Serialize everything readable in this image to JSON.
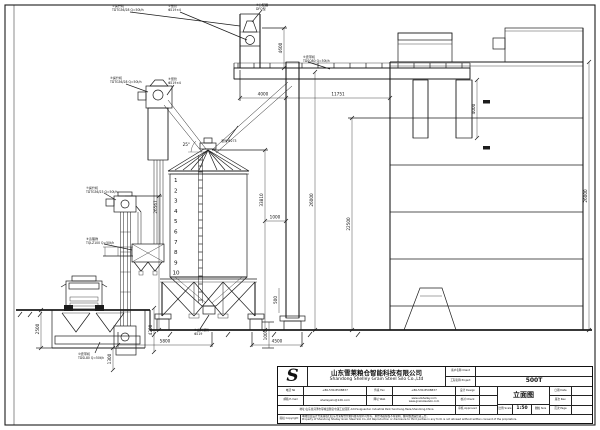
{
  "titleblock": {
    "logo": "S",
    "company_cn": "山东雪莱粮仓智能科技有限公司",
    "company_en": "Shandong Shelley Grain Steel Silo Co.,Ltd",
    "client_label": "客户名称 Client",
    "project_label": "工程名称 Project",
    "project_value": "500T",
    "tel_label": "电话 Tel",
    "tel_value": "+86-530-8508837",
    "fax_label": "传真 Fax",
    "fax_value": "+86-530-8508837",
    "email_label": "邮箱 E-mail",
    "email_value": "shelleysilo@126.com",
    "web_label": "网址 Web",
    "web_value1": "www.sdshelley.com",
    "web_value2": "www.grainsteelsilo.com",
    "address": "地址:山东省菏泽市郓城县随官屯镇工业园区  Add:Suiguantun Industrial Park,Yuncheng,Heze,Shandong,China",
    "design_label": "设计 Design",
    "check_label": "校对 Check",
    "approve_label": "审核 Approved",
    "date_label": "日期 Date",
    "rev_label": "版次 Rev.",
    "page_label": "页次 Page",
    "drawing_title": "立面图",
    "scale_label": "比例 Scale",
    "scale_value": "1:50",
    "size_label": "图幅 Size",
    "note_label": "版权 Copyright",
    "notice_cn": "本图纸及设计方案版权归山东雪莱粮仓智能科技有限公司所有，未经书面授权不得复制、翻印或透露给第三方。",
    "notice_en": "Property of Shandong Shelley Grain Steel Silo Co.,Ltd Reproduction or disclosure to third parties in any form is not allowed without written consent of the proprietors."
  },
  "dims": {
    "top_left": "4000",
    "top_span": "11751",
    "head_tower": "4600",
    "col_right": "4000",
    "tower_h": "26000",
    "building_h2": "22500",
    "silo_total": "33810",
    "silo_gap": "1000",
    "footing": "500",
    "elev_total": "26567",
    "building_right": "26000",
    "pit_depth": "2500",
    "pit_right": "4200",
    "pit_below": "1300",
    "silo_span": "5800",
    "pier": "1000",
    "tower_span": "4500",
    "roof_angle": "25°"
  },
  "rings": [
    "1",
    "2",
    "3",
    "4",
    "5",
    "6",
    "7",
    "8",
    "9",
    "10"
  ],
  "callouts": {
    "c1": {
      "l1": "①提升机",
      "l2": "TDTG36/28 Q=50t/h"
    },
    "c2": {
      "l1": "②溜管",
      "l2": "Φ219×4"
    },
    "c3": {
      "l1": "③分配器",
      "l2": "DFQ型"
    },
    "c4": {
      "l1": "④提升机",
      "l2": "TDTG36/28 Q=50t/h"
    },
    "c5": {
      "l1": "⑤溜管",
      "l2": "Φ219×4"
    },
    "c6": {
      "l1": "⑥皮带机",
      "l2": "TDSQ80 Q=50t/h"
    },
    "c7": {
      "l1": "⑦提升机",
      "l2": "TDTG36/23 Q=50t/h"
    },
    "c8": {
      "l1": "⑧清理筛",
      "l2": "TQLZ100 Q=50t/h"
    },
    "c9": {
      "l1": "⑨出料溜管",
      "l2": "Φ219"
    },
    "c10": {
      "l1": "⑩皮带机",
      "l2": "TDSL80 Q=50t/h"
    },
    "c11": {
      "l1": "溜管 Φ273",
      "l2": ""
    }
  }
}
